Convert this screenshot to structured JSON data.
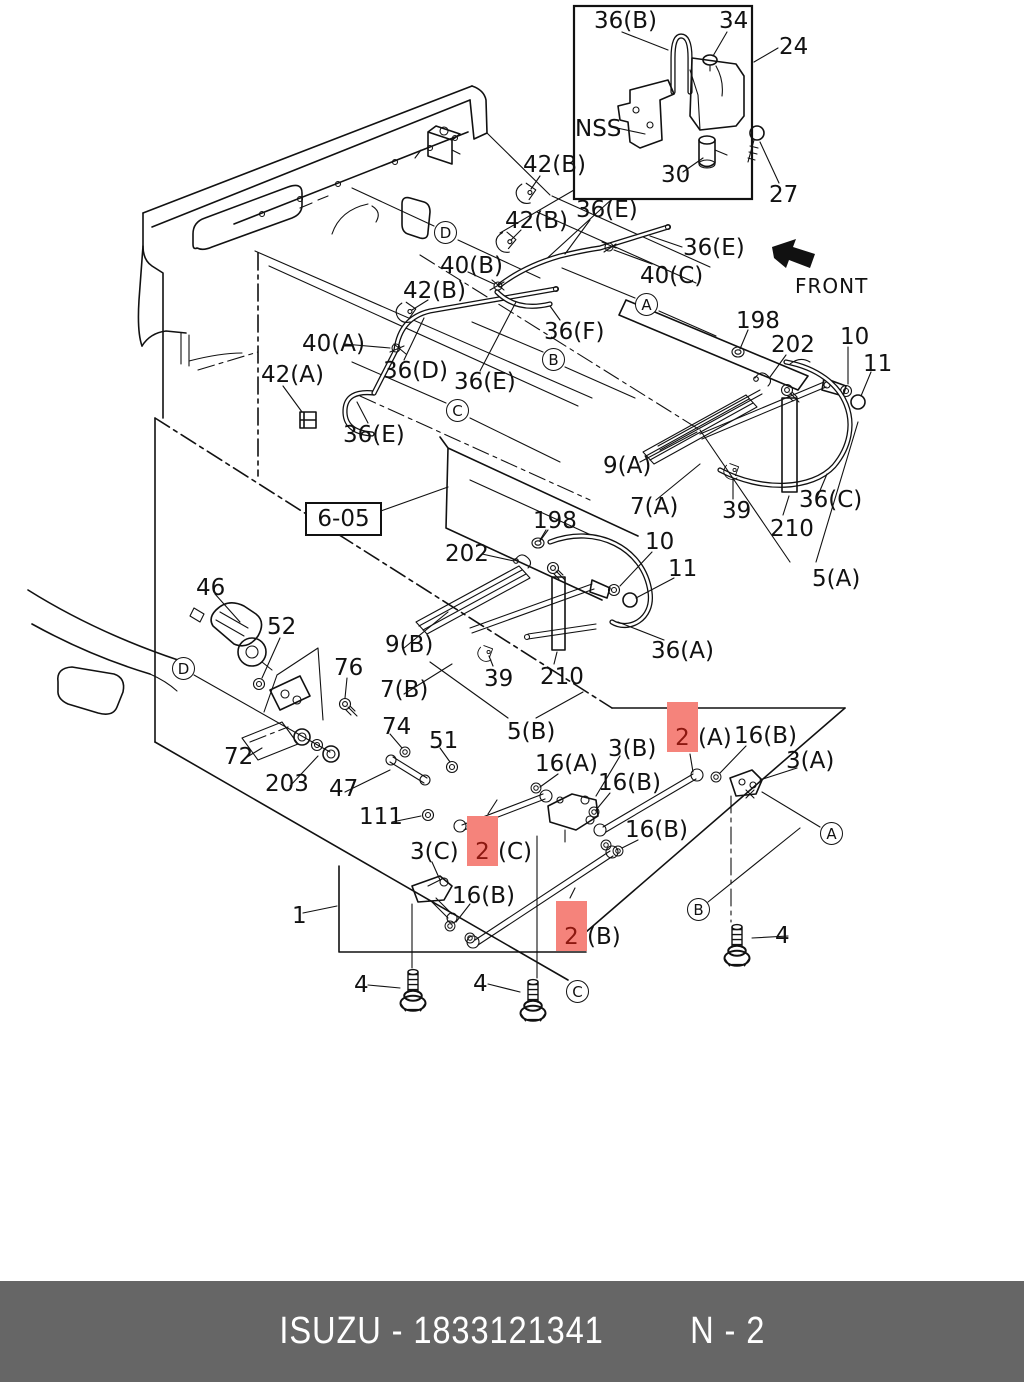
{
  "page": {
    "background": "#ffffff",
    "line_color": "#111111"
  },
  "footer": {
    "background": "#666666",
    "left": "ISUZU - 1833121341",
    "right": "N - 2"
  },
  "diagram": {
    "front_label": "FRONT",
    "ref_box_label": "6-05",
    "highlight_color": "#f5837b",
    "labels": [
      {
        "text": "36(B)",
        "x": 594,
        "y": 10
      },
      {
        "text": "34",
        "x": 719,
        "y": 10
      },
      {
        "text": "24",
        "x": 779,
        "y": 36
      },
      {
        "text": "NSS",
        "x": 575,
        "y": 118
      },
      {
        "text": "30",
        "x": 661,
        "y": 164
      },
      {
        "text": "27",
        "x": 769,
        "y": 184
      },
      {
        "text": "42(B)",
        "x": 523,
        "y": 154
      },
      {
        "text": "42(B)",
        "x": 505,
        "y": 210
      },
      {
        "text": "36(E)",
        "x": 576,
        "y": 199
      },
      {
        "text": "36(E)",
        "x": 683,
        "y": 237
      },
      {
        "text": "40(C)",
        "x": 640,
        "y": 265
      },
      {
        "text": "40(B)",
        "x": 440,
        "y": 255
      },
      {
        "text": "42(B)",
        "x": 403,
        "y": 280
      },
      {
        "text": "40(A)",
        "x": 302,
        "y": 333
      },
      {
        "text": "36(D)",
        "x": 383,
        "y": 360
      },
      {
        "text": "36(E)",
        "x": 454,
        "y": 371
      },
      {
        "text": "42(A)",
        "x": 261,
        "y": 364
      },
      {
        "text": "36(E)",
        "x": 343,
        "y": 424
      },
      {
        "text": "36(F)",
        "x": 544,
        "y": 321
      },
      {
        "text": "198",
        "x": 736,
        "y": 310
      },
      {
        "text": "202",
        "x": 771,
        "y": 334
      },
      {
        "text": "10",
        "x": 840,
        "y": 326
      },
      {
        "text": "11",
        "x": 863,
        "y": 353
      },
      {
        "text": "9(A)",
        "x": 603,
        "y": 455
      },
      {
        "text": "7(A)",
        "x": 630,
        "y": 496
      },
      {
        "text": "39",
        "x": 722,
        "y": 500
      },
      {
        "text": "210",
        "x": 770,
        "y": 518
      },
      {
        "text": "36(C)",
        "x": 799,
        "y": 489
      },
      {
        "text": "5(A)",
        "x": 812,
        "y": 568
      },
      {
        "text": "198",
        "x": 533,
        "y": 510
      },
      {
        "text": "202",
        "x": 445,
        "y": 543
      },
      {
        "text": "10",
        "x": 645,
        "y": 531
      },
      {
        "text": "11",
        "x": 668,
        "y": 558
      },
      {
        "text": "46",
        "x": 196,
        "y": 577
      },
      {
        "text": "52",
        "x": 267,
        "y": 616
      },
      {
        "text": "76",
        "x": 334,
        "y": 657
      },
      {
        "text": "9(B)",
        "x": 385,
        "y": 634
      },
      {
        "text": "7(B)",
        "x": 380,
        "y": 679
      },
      {
        "text": "39",
        "x": 484,
        "y": 668
      },
      {
        "text": "210",
        "x": 540,
        "y": 666
      },
      {
        "text": "36(A)",
        "x": 651,
        "y": 640
      },
      {
        "text": "5(B)",
        "x": 507,
        "y": 721
      },
      {
        "text": "74",
        "x": 382,
        "y": 716
      },
      {
        "text": "51",
        "x": 429,
        "y": 730
      },
      {
        "text": "72",
        "x": 224,
        "y": 746
      },
      {
        "text": "203",
        "x": 265,
        "y": 773
      },
      {
        "text": "47",
        "x": 329,
        "y": 778
      },
      {
        "text": "111",
        "x": 359,
        "y": 806
      },
      {
        "text": "3(C)",
        "x": 410,
        "y": 841
      },
      {
        "text": "16(B)",
        "x": 452,
        "y": 885
      },
      {
        "text": "1",
        "x": 292,
        "y": 905
      },
      {
        "text": "16(A)",
        "x": 535,
        "y": 753
      },
      {
        "text": "3(B)",
        "x": 608,
        "y": 738
      },
      {
        "text": "16(B)",
        "x": 598,
        "y": 772
      },
      {
        "text": "16(B)",
        "x": 625,
        "y": 819
      },
      {
        "text": "16(B)",
        "x": 734,
        "y": 725
      },
      {
        "text": "3(A)",
        "x": 786,
        "y": 750
      },
      {
        "text": "4",
        "x": 354,
        "y": 974
      },
      {
        "text": "4",
        "x": 473,
        "y": 973
      },
      {
        "text": "4",
        "x": 775,
        "y": 925
      },
      {
        "text": "2",
        "suffix": "(C)",
        "x": 467,
        "y": 816,
        "highlight": true
      },
      {
        "text": "2",
        "suffix": "(B)",
        "x": 556,
        "y": 901,
        "highlight": true
      },
      {
        "text": "2",
        "suffix": "(A)",
        "x": 667,
        "y": 702,
        "highlight": true
      }
    ],
    "markers": [
      {
        "letter": "A",
        "x": 647,
        "y": 305
      },
      {
        "letter": "B",
        "x": 554,
        "y": 360
      },
      {
        "letter": "C",
        "x": 458,
        "y": 411
      },
      {
        "letter": "D",
        "x": 446,
        "y": 233
      },
      {
        "letter": "D",
        "x": 184,
        "y": 669
      },
      {
        "letter": "A",
        "x": 832,
        "y": 834
      },
      {
        "letter": "B",
        "x": 699,
        "y": 910
      },
      {
        "letter": "C",
        "x": 578,
        "y": 992
      }
    ]
  }
}
